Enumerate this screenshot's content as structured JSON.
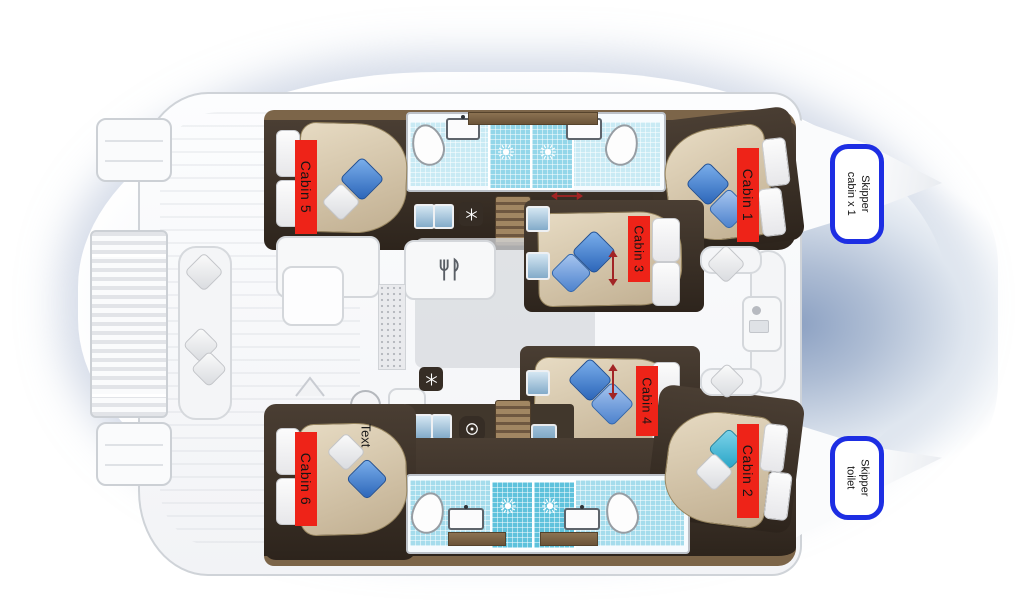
{
  "diagram_type": "catamaran-deck-floor-plan",
  "labels": {
    "cabins": [
      {
        "id": "cabin-1",
        "label": "Cabin 1"
      },
      {
        "id": "cabin-2",
        "label": "Cabin 2"
      },
      {
        "id": "cabin-3",
        "label": "Cabin 3"
      },
      {
        "id": "cabin-4",
        "label": "Cabin 4"
      },
      {
        "id": "cabin-5",
        "label": "Cabin 5"
      },
      {
        "id": "cabin-6",
        "label": "Cabin 6"
      }
    ],
    "skipper": [
      {
        "id": "skipper-cabin",
        "line1": "Skipper",
        "line2": "cabin x 1"
      },
      {
        "id": "skipper-toilet",
        "line1": "Skipper",
        "line2": "toilet"
      }
    ],
    "placeholder": {
      "text": "Text"
    }
  },
  "colors": {
    "cabin_label_red": "#ee2318",
    "skipper_border_blue": "#1d2ee3",
    "hull_interior_brown": "#362d25",
    "wood_trim": "#7c6549",
    "bed_tan": "#d4c4a8",
    "pillow_blue": "#3f7cc8",
    "pillow_cyan": "#3fb6d6",
    "bathroom_tile_cyan": "#9cd8e8",
    "shower_tile_cyan": "#5fc2dc",
    "water_shadow_blue": "#9dafca",
    "arrow_red": "#a22425"
  },
  "icons": [
    "sun-icon",
    "snowflake-icon",
    "washer-icon",
    "galley-icon",
    "stairs",
    "double-arrow-icon",
    "up-arrow-icon"
  ]
}
